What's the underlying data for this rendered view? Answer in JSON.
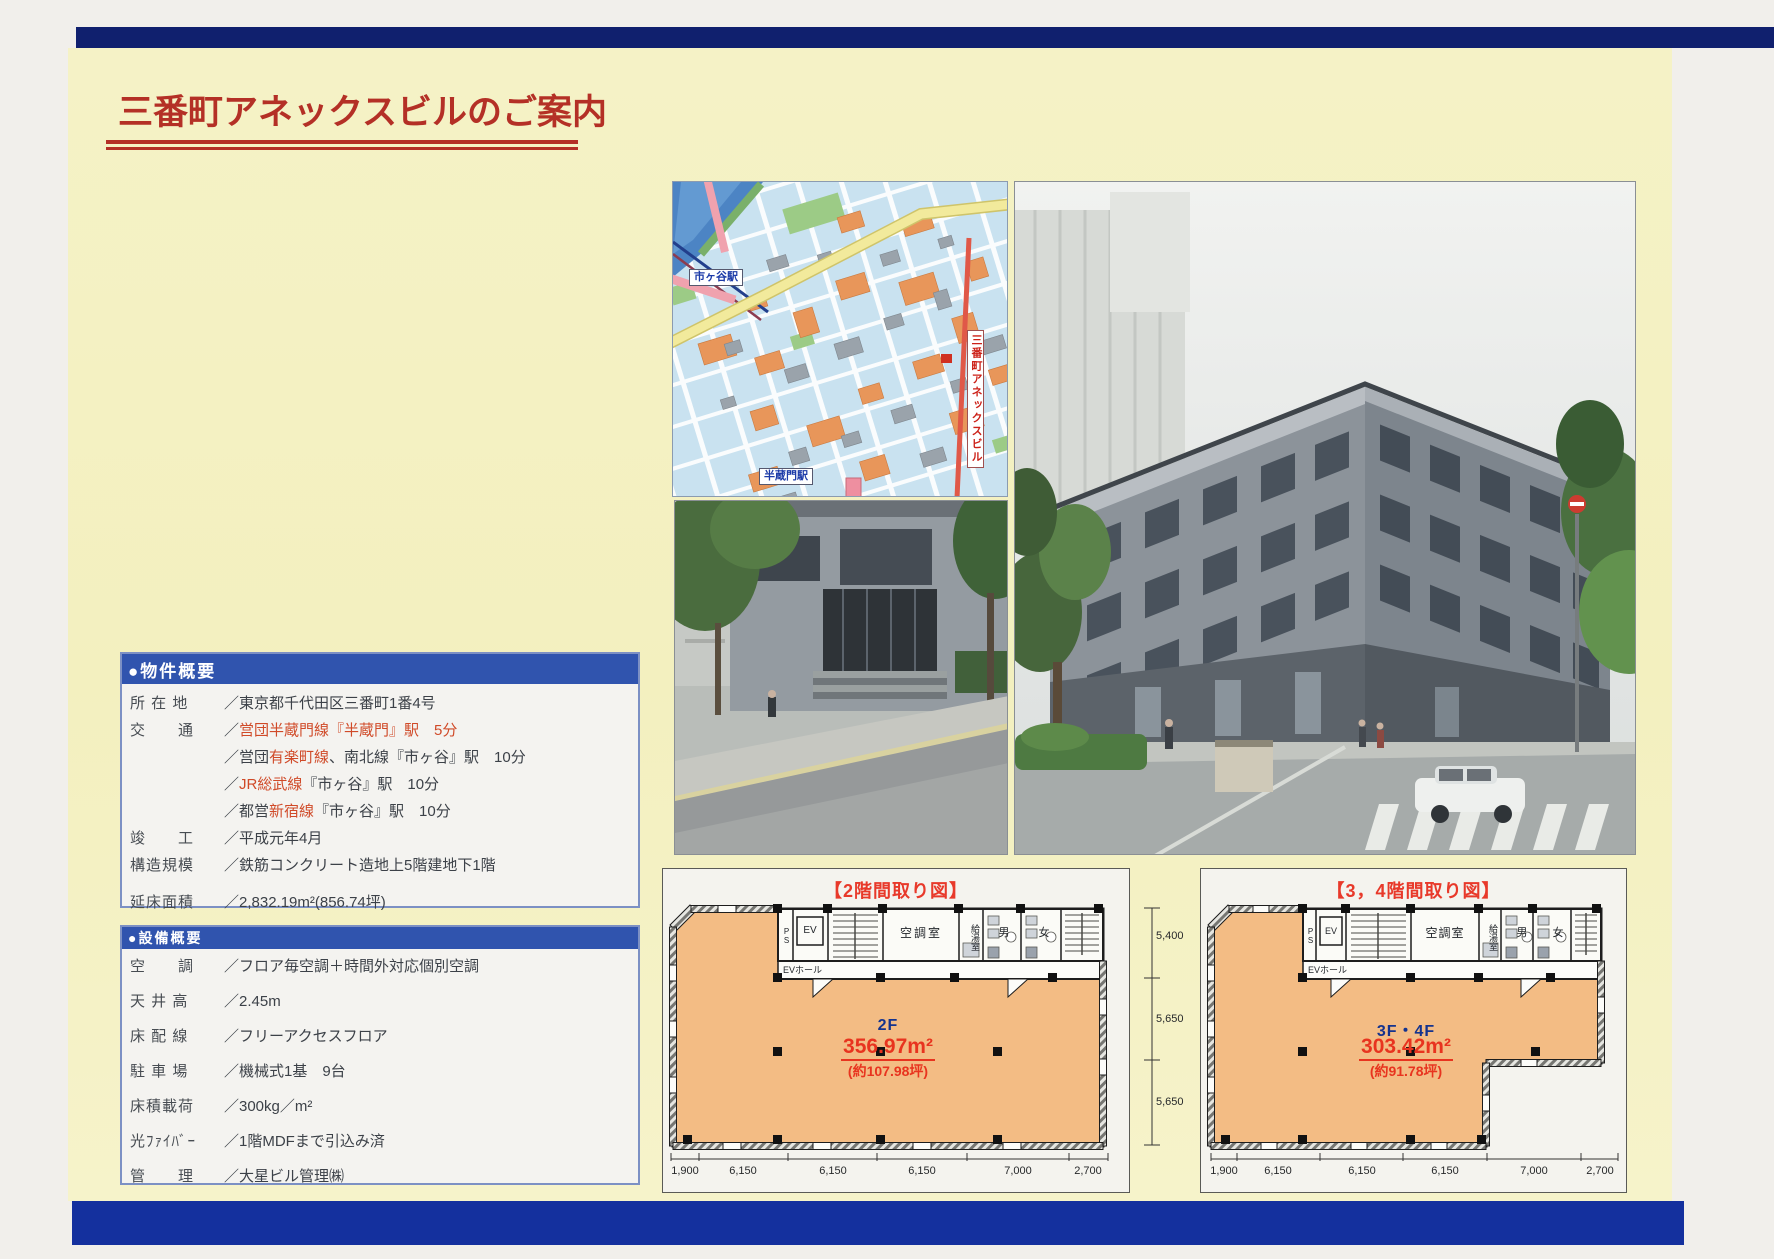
{
  "page": {
    "title": "三番町アネックスビルのご案内"
  },
  "map": {
    "station_top": "市ヶ谷駅",
    "station_bottom": "半蔵門駅",
    "building_label": "三番町アネックスビル"
  },
  "property": {
    "header": "●物件概要",
    "rows": [
      {
        "label": "所 在 地",
        "pre": "／東京都千代田区三番町1番4号",
        "red": "",
        "post": ""
      },
      {
        "label": "交　　通",
        "pre": "／",
        "red": "営団半蔵門線『半蔵門』駅　5分",
        "post": ""
      },
      {
        "label": "",
        "pre": "／営団",
        "red": "有楽町線",
        "post": "、南北線『市ヶ谷』駅　10分"
      },
      {
        "label": "",
        "pre": "／",
        "red": "JR総武線",
        "post": "『市ヶ谷』駅　10分"
      },
      {
        "label": "",
        "pre": "／都営",
        "red": "新宿線",
        "post": "『市ヶ谷』駅　10分"
      },
      {
        "label": "竣　　工",
        "pre": "／平成元年4月",
        "red": "",
        "post": ""
      },
      {
        "label": "構造規模",
        "pre": "／鉄筋コンクリート造地上5階建地下1階",
        "red": "",
        "post": ""
      },
      {
        "label": "延床面積",
        "pre": "／2,832.19m²(856.74坪)",
        "red": "",
        "post": ""
      }
    ]
  },
  "facility": {
    "header": "●設備概要",
    "rows": [
      {
        "label": "空　　調",
        "value": "／フロア毎空調＋時間外対応個別空調"
      },
      {
        "label": "天 井 高",
        "value": "／2.45m"
      },
      {
        "label": "床 配 線",
        "value": "／フリーアクセスフロア"
      },
      {
        "label": "駐 車 場",
        "value": "／機械式1基　9台"
      },
      {
        "label": "床積載荷",
        "value": "／300kg／m²"
      },
      {
        "label": "光ﾌｧｲﾊﾞｰ",
        "value": "／1階MDFまで引込み済"
      },
      {
        "label": "管　　理",
        "value": "／大星ビル管理㈱"
      }
    ]
  },
  "floorplans": {
    "rooms": {
      "ps": "PS",
      "ev": "EV",
      "hall": "EVホール",
      "ac": "空調室",
      "pantry": "給湯室",
      "men": "男",
      "women": "女"
    },
    "left": {
      "title": "【2階間取り図】",
      "floor": "2F",
      "area": "356.97m²",
      "tsubo": "(約107.98坪)",
      "dims": [
        "1,900",
        "6,150",
        "6,150",
        "6,150",
        "7,000",
        "2,700"
      ]
    },
    "right": {
      "title": "【3，4階間取り図】",
      "floor": "3F・4F",
      "area": "303.42m²",
      "tsubo": "(約91.78坪)",
      "dims": [
        "1,900",
        "6,150",
        "6,150",
        "6,150",
        "7,000",
        "2,700"
      ]
    },
    "side_dims": [
      "5,400",
      "5,650",
      "5,650"
    ]
  }
}
